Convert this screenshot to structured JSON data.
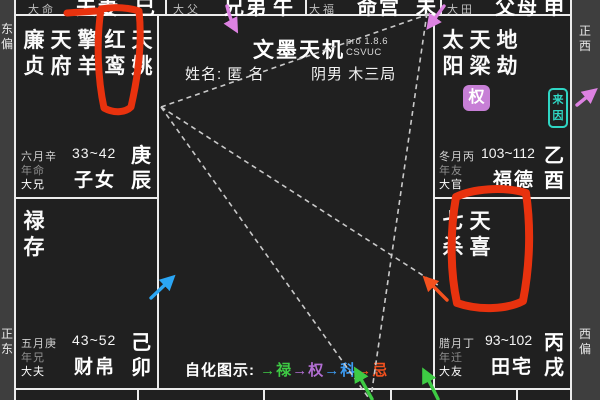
{
  "app": {
    "name": "文墨天机",
    "version": "pro 1.8.6",
    "edition": "CSVUC"
  },
  "profile": {
    "name_label": "姓名:",
    "name_value": "匿 名",
    "gender": "阴男",
    "wuxing_bureau": "木三局"
  },
  "legend": {
    "label": "自化图示:",
    "items": [
      {
        "name": "zihua-lu",
        "text": "→禄",
        "color": "#3ecb44"
      },
      {
        "name": "zihua-quan",
        "text": "→权",
        "color": "#b36fd4"
      },
      {
        "name": "zihua-ke",
        "text": "→科",
        "color": "#3d9df5"
      },
      {
        "name": "zihua-ji",
        "text": "→忌",
        "color": "#f4511e"
      }
    ]
  },
  "compass": {
    "left_top": "东偏",
    "left_bottom": "正东",
    "right_top": "正西",
    "right_bottom": "西偏"
  },
  "top_row": [
    {
      "decade_label": "大命",
      "palace_name": "夫妻",
      "branch": "巳"
    },
    {
      "decade_label": "大父",
      "palace_name": "兄弟",
      "branch": "午"
    },
    {
      "decade_label": "大福",
      "palace_name": "命宫",
      "branch": "未"
    },
    {
      "decade_label": "大田",
      "palace_name": "父母",
      "branch": "申"
    }
  ],
  "palaces": {
    "chen": {
      "stars": [
        "廉贞",
        "天府",
        "擎羊",
        "红鸾",
        "天姚"
      ],
      "month_stem": "六月辛",
      "age_range": "33~42",
      "year_label": "年命",
      "decade_label": "大兄",
      "palace_name": "子女",
      "stem_branch": "庚辰"
    },
    "mao": {
      "stars": [
        "禄存"
      ],
      "month_stem": "五月庚",
      "age_range": "43~52",
      "year_label": "年兄",
      "decade_label": "大夫",
      "palace_name": "财帛",
      "stem_branch": "己卯"
    },
    "you": {
      "stars": [
        "太阳",
        "天梁",
        "地劫"
      ],
      "sihua_badge": "权",
      "laiyin_badge": "来因",
      "month_stem": "冬月丙",
      "age_range": "103~112",
      "year_label": "年友",
      "decade_label": "大官",
      "palace_name": "福德",
      "stem_branch": "乙酉"
    },
    "xu": {
      "stars": [
        "七杀",
        "天喜"
      ],
      "month_stem": "腊月丁",
      "age_range": "93~102",
      "year_label": "年迁",
      "decade_label": "大友",
      "palace_name": "田宅",
      "stem_branch": "丙戌"
    }
  },
  "colors": {
    "background": "#202020",
    "grid_line": "#ececec",
    "side_strip": "#3e3e3e",
    "red_marker": "#e8320e",
    "arrow_pink": "#dd82e2",
    "arrow_cyan": "#2ba6f5",
    "arrow_orange": "#f4511e",
    "arrow_green": "#3ecb44",
    "badge_quan_bg": "#c77fd6",
    "badge_laiyin": "#2fd6c4",
    "dashed_line": "#c9c9c9"
  }
}
